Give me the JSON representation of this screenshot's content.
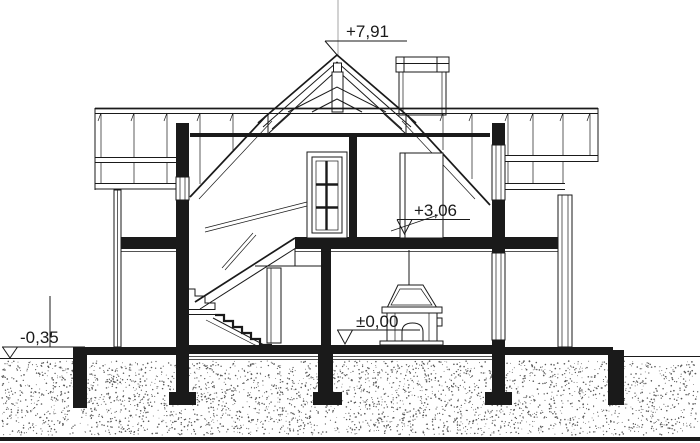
{
  "drawing": {
    "kind": "architectural-cross-section",
    "colors": {
      "background": "#ffffff",
      "line": "#1a1a1a",
      "centerline": "#b3b3b3",
      "ground_dots": "#585858"
    },
    "levels": [
      {
        "name": "ridge",
        "label": "+7,91"
      },
      {
        "name": "attic-floor",
        "label": "+3,06"
      },
      {
        "name": "ground-floor",
        "label": "±0,00"
      },
      {
        "name": "terrain",
        "label": "-0,35"
      }
    ]
  }
}
